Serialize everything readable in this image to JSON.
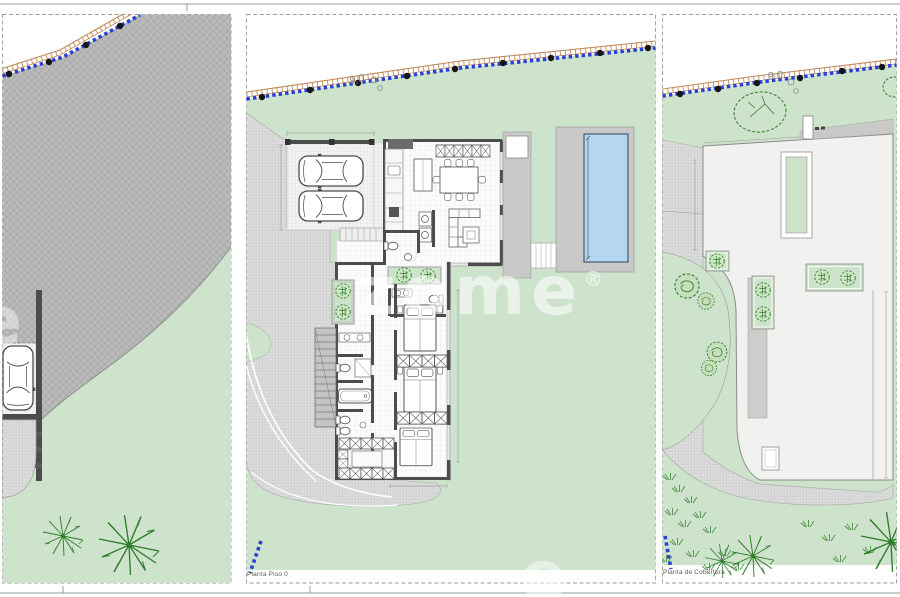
{
  "panels": {
    "floor": {
      "label": "Planta Piso 0"
    },
    "roof": {
      "label": "Planta de Cobertura"
    }
  },
  "annotations": {
    "road_level_mark": "9,0"
  },
  "watermark": {
    "text": "zome",
    "reg": "®",
    "partial": "e"
  },
  "colors": {
    "lawn": "#cee3cb",
    "drive": "#bababa",
    "driveLine": "#a2a2a2",
    "gravel": "#dcdcdc",
    "gravelLine": "#bcbcbc",
    "tile": "#fcfcfc",
    "tileLine": "#e7e7e7",
    "padBase": "#f3f3f3",
    "padLine": "#d6d6d6",
    "wall": "#4c4c4c",
    "deck": "#c9c9c8",
    "roof": "#f1f1ef",
    "pool": "#b5d6f0",
    "poolEdge": "#47566e",
    "boundaryBlue": "#2840d4",
    "fenceOrange": "#c08a5c",
    "marker": "#151515",
    "tree": "#2f7d2b",
    "sheetLine": "#9a9a9a",
    "dim": "#8c8c8c",
    "label": "#5a5a5a",
    "watermark": "rgba(255,255,255,0.58)"
  }
}
